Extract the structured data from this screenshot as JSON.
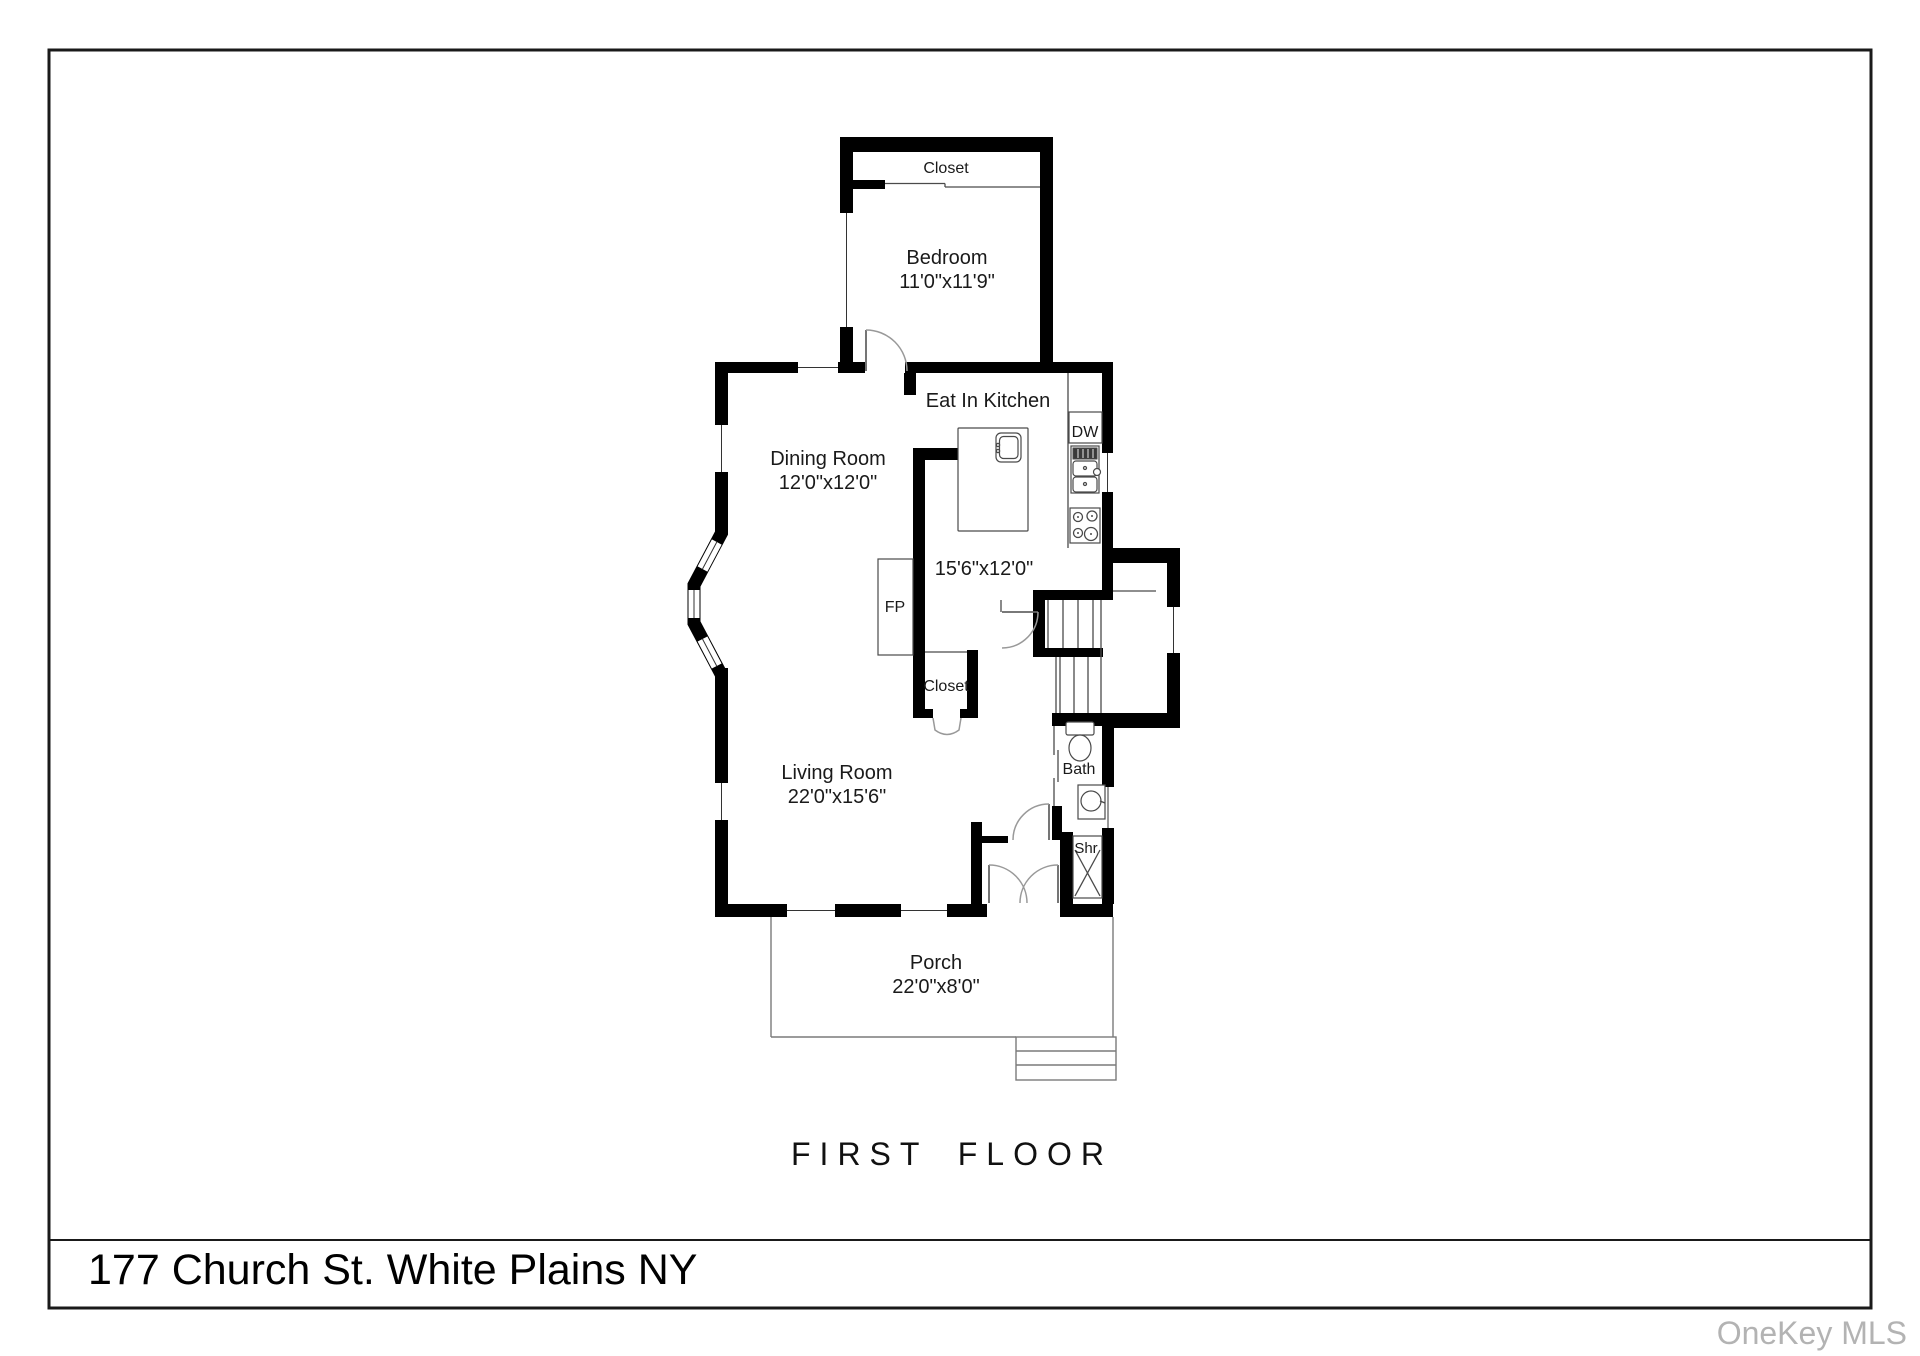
{
  "page": {
    "title": "FIRST FLOOR",
    "address": "177 Church St. White Plains NY",
    "watermark": "OneKey MLS"
  },
  "rooms": {
    "bedroom": {
      "name": "Bedroom",
      "dims": "11'0\"x11'9\""
    },
    "bedroom_closet": {
      "name": "Closet"
    },
    "kitchen": {
      "name": "Eat In Kitchen",
      "dims": "15'6\"x12'0\""
    },
    "dining": {
      "name": "Dining Room",
      "dims": "12'0\"x12'0\""
    },
    "living": {
      "name": "Living Room",
      "dims": "22'0\"x15'6\""
    },
    "living_closet": {
      "name": "Closet"
    },
    "bath": {
      "name": "Bath"
    },
    "shower": {
      "abbr": "Shr"
    },
    "porch": {
      "name": "Porch",
      "dims": "22'0\"x8'0\""
    }
  },
  "fixtures": {
    "fireplace_abbr": "FP",
    "dishwasher_abbr": "DW"
  }
}
